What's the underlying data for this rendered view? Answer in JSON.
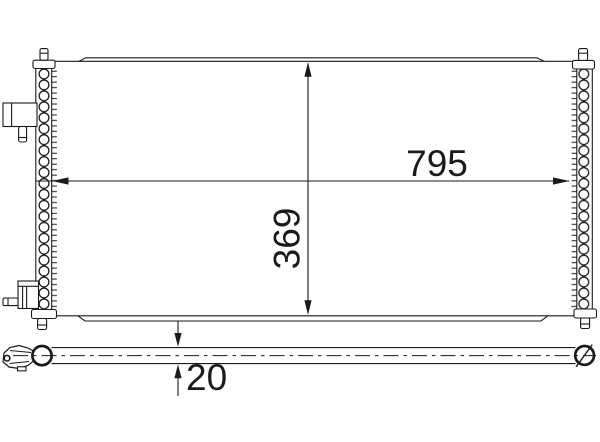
{
  "dimensions": {
    "width": "795",
    "core_height": "369",
    "depth": "20"
  },
  "colors": {
    "line": "#1a1a1a",
    "background": "#ffffff"
  }
}
